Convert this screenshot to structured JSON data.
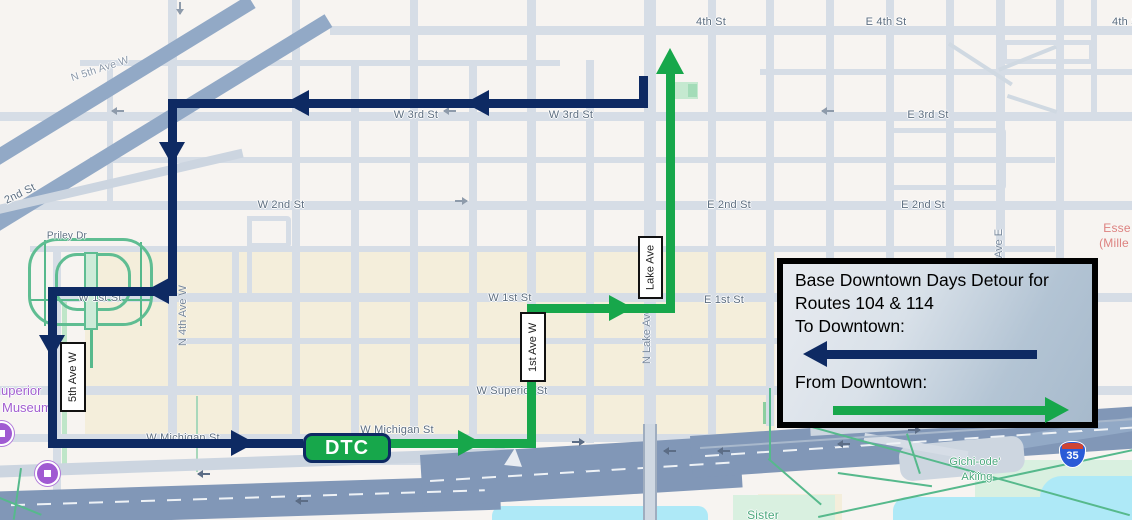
{
  "legend": {
    "line1": "Base Downtown Days Detour for",
    "line2": "Routes 104 & 114",
    "to_label": "To Downtown:",
    "from_label": "From Downtown:"
  },
  "badge": {
    "label": "DTC"
  },
  "routes": {
    "to_downtown_color": "#0e2a63",
    "from_downtown_color": "#17a74b"
  },
  "map": {
    "street_labels": [
      {
        "text": "4th St"
      },
      {
        "text": "E 4th St"
      },
      {
        "text": "4th St"
      },
      {
        "text": "W 3rd St"
      },
      {
        "text": "W 3rd St"
      },
      {
        "text": "E 3rd St"
      },
      {
        "text": "W 2nd St"
      },
      {
        "text": "E 2nd St"
      },
      {
        "text": "E 2nd St"
      },
      {
        "text": "W 1st St"
      },
      {
        "text": "W 1st St"
      },
      {
        "text": "E 1st St"
      },
      {
        "text": "W Superior St"
      },
      {
        "text": "W Michigan St"
      },
      {
        "text": "W Michigan St"
      }
    ],
    "boxed_labels": [
      {
        "text": "5th Ave W"
      },
      {
        "text": "1st Ave W"
      },
      {
        "text": "Lake Ave"
      }
    ],
    "vertical_labels": [
      {
        "text": "N 4th Ave W"
      },
      {
        "text": "N Lake Ave"
      },
      {
        "text": "Ave E"
      }
    ],
    "diagonal_labels": [
      {
        "text": "N 5th Ave W"
      },
      {
        "text": "2nd St"
      }
    ],
    "poi_labels": {
      "museum_line1": "uperior",
      "museum_line2": "Museum",
      "hospital_line1": "Esse",
      "hospital_line2": "(Mille",
      "park_priley": "Priley Dr",
      "park_gichi_line1": "Gichi-ode'",
      "park_gichi_line2": "Akiing",
      "park_sister": "Sister",
      "interstate_shield": "35"
    }
  }
}
